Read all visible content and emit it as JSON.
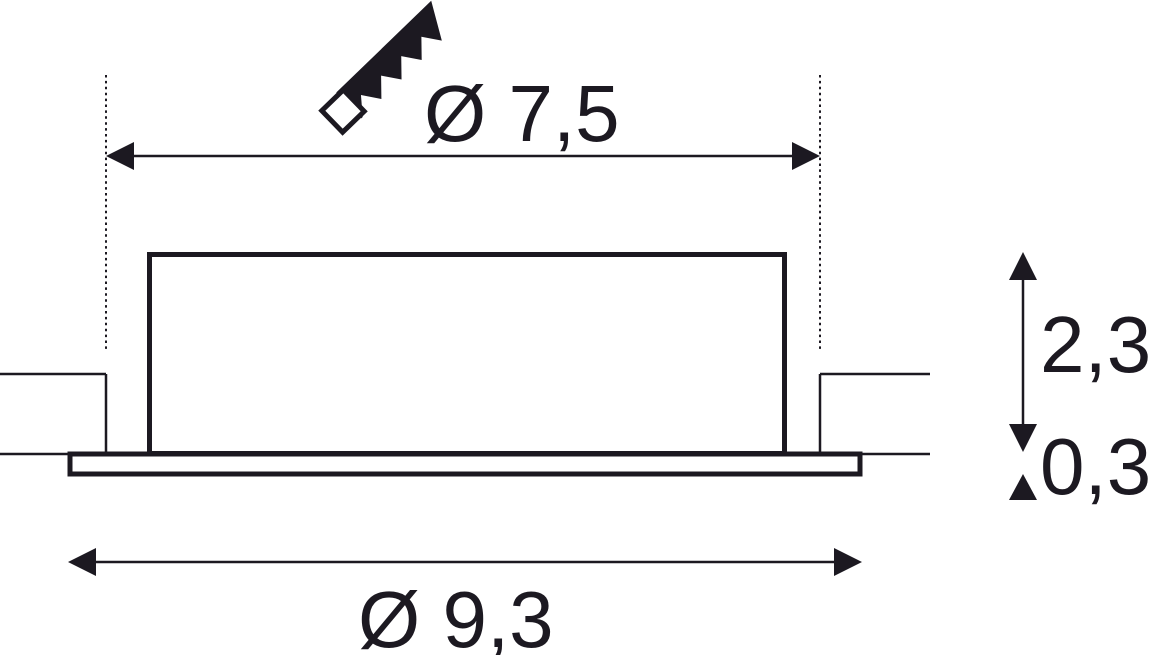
{
  "drawing": {
    "background": "#ffffff",
    "ink": "#1c1921",
    "labels": {
      "cutout_diameter": "Ø 7,5",
      "overall_diameter": "Ø 9,3",
      "recess_height": "2,3",
      "rim_thickness": "0,3"
    },
    "icon": "saw-blade-icon"
  }
}
